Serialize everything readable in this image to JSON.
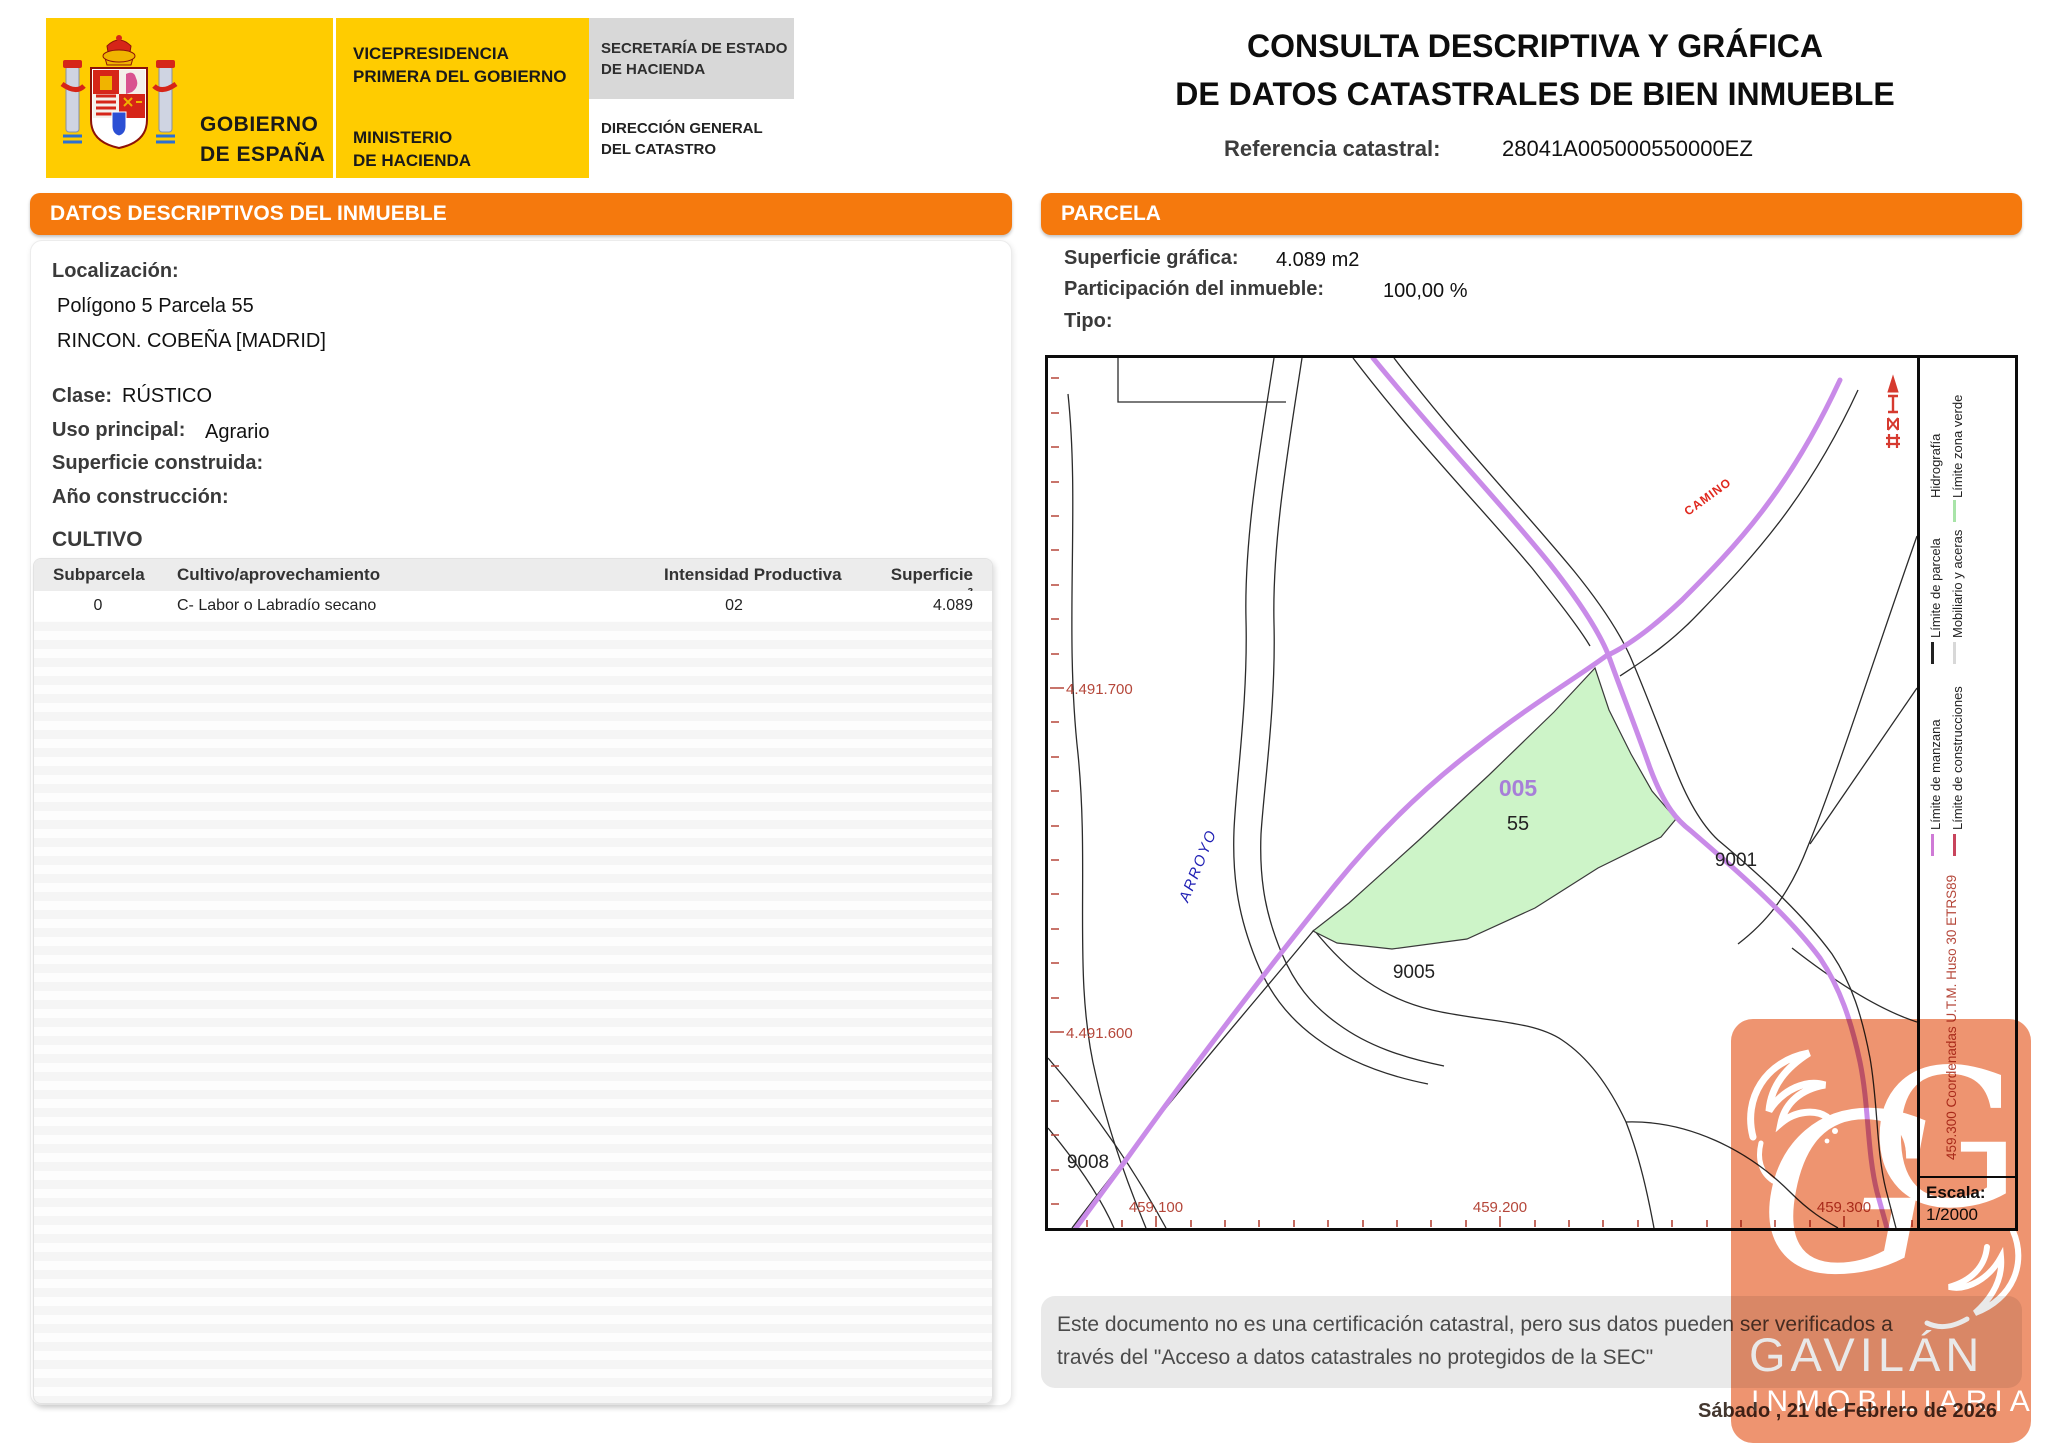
{
  "header": {
    "logo": {
      "gobierno_l1": "GOBIERNO",
      "gobierno_l2": "DE ESPAÑA",
      "vicepresidencia_l1": "VICEPRESIDENCIA",
      "vicepresidencia_l2": "PRIMERA DEL GOBIERNO",
      "ministerio_l1": "MINISTERIO",
      "ministerio_l2": "DE HACIENDA",
      "secretaria_l1": "SECRETARÍA DE ESTADO",
      "secretaria_l2": "DE HACIENDA",
      "direccion_l1": "DIRECCIÓN GENERAL",
      "direccion_l2": "DEL CATASTRO"
    },
    "title_l1": "CONSULTA DESCRIPTIVA Y GRÁFICA",
    "title_l2": "DE DATOS CATASTRALES DE BIEN INMUEBLE",
    "referencia_label": "Referencia catastral:",
    "referencia_value": "28041A005000550000EZ"
  },
  "left_panel": {
    "banner": "DATOS DESCRIPTIVOS DEL INMUEBLE",
    "localizacion_label": "Localización:",
    "localizacion_line1": "Polígono 5 Parcela 55",
    "localizacion_line2": "RINCON. COBEÑA [MADRID]",
    "clase_label": "Clase:",
    "clase_value": "RÚSTICO",
    "uso_label": "Uso principal:",
    "uso_value": "Agrario",
    "superficie_label": "Superficie construida:",
    "anio_label": "Año construcción:",
    "cultivo": {
      "title": "CULTIVO",
      "columns": [
        "Subparcela",
        "Cultivo/aprovechamiento",
        "Intensidad Productiva",
        "Superficie m²"
      ],
      "rows": [
        {
          "subparcela": "0",
          "cultivo": "C- Labor o Labradío secano",
          "intensidad": "02",
          "superficie": "4.089"
        }
      ]
    }
  },
  "right_panel": {
    "banner": "PARCELA",
    "superficie_label": "Superficie gráfica:",
    "superficie_value": "4.089 m2",
    "participacion_label": "Participación del inmueble:",
    "participacion_value": "100,00 %",
    "tipo_label": "Tipo:"
  },
  "map": {
    "y_label_top": "4.491.700",
    "y_label_bottom": "4.491.600",
    "x_label_1": "459.100",
    "x_label_2": "459.200",
    "x_label_3": "459.300",
    "parcel_code": "005",
    "parcel_number": "55",
    "label_9001": "9001",
    "label_9005": "9005",
    "label_9008": "9008",
    "arroyo_label": "ARROYO",
    "camino_label": "CAMINO",
    "parcel_fill": "#CDF4C8",
    "road_color": "#C98BE8",
    "coord_red": "#B5473A",
    "legend": [
      {
        "label": "Hidrografía",
        "color": "#8078E8",
        "swatch_style": "--c:#8078E8"
      },
      {
        "label": "Límite zona verde",
        "color": "#A8E4A8",
        "swatch_style": "--c:#A8E4A8"
      },
      {
        "label": "Límite de parcela",
        "color": "#222222",
        "swatch_style": "--c:#222222"
      },
      {
        "label": "Mobiliario y aceras",
        "color": "#D8D8D8",
        "swatch_style": "--c:#D8D8D8"
      },
      {
        "label": "Límite de manzana",
        "color": "#CF7AD6",
        "swatch_style": "--c:#CF7AD6"
      },
      {
        "label": "Límite de construcciones",
        "color": "#C8445C",
        "swatch_style": "--c:#C8445C"
      }
    ],
    "coords_note": "459.300 Coordenadas U.T.M. Huso 30 ETRS89",
    "escala_label": "Escala:",
    "escala_value": "1/2000"
  },
  "footer": {
    "disclaimer_l1": "Este documento no es una certificación catastral, pero sus datos pueden ser verificados a",
    "disclaimer_l2": "través del \"Acceso a datos catastrales no protegidos de la SEC\"",
    "date": "Sábado , 21 de Febrero de 2026"
  },
  "watermark": {
    "brand": "GAVILÁN",
    "sub": "INMOBILIARIA",
    "color": "#EE9470"
  }
}
